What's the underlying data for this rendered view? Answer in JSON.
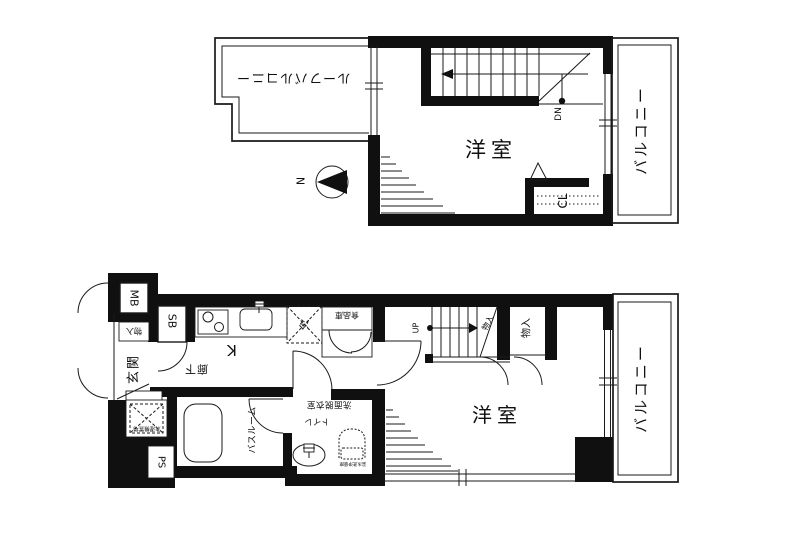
{
  "page": {
    "background": "#ffffff",
    "wall_color": "#101010",
    "line_color": "#1a1a1a"
  },
  "floors": {
    "upper": {
      "roof_balcony": "ルーフバルコニー",
      "bedroom": "洋室",
      "closet": "CL",
      "balcony": "バルコニー",
      "stair_direction": "DN",
      "compass_north": "N"
    },
    "lower": {
      "meter_box": "MB",
      "storage_entry": "物入",
      "entrance": "玄関",
      "shoe_box": "SB",
      "hallway": "廊下",
      "kitchen": "K",
      "refrigerator": "冷",
      "pantry": "食品庫",
      "stair_direction": "UP",
      "storage_under_stairs": "物入",
      "storage_closet": "物入",
      "bedroom": "洋室",
      "balcony": "バルコニー",
      "washroom": "洗面脱衣室",
      "toilet": "トイレ",
      "bathroom": "バスルーム",
      "washer_space": "洗濯機置場",
      "toilet_note": "温水洗浄便座",
      "pipe_space": "PS"
    }
  }
}
